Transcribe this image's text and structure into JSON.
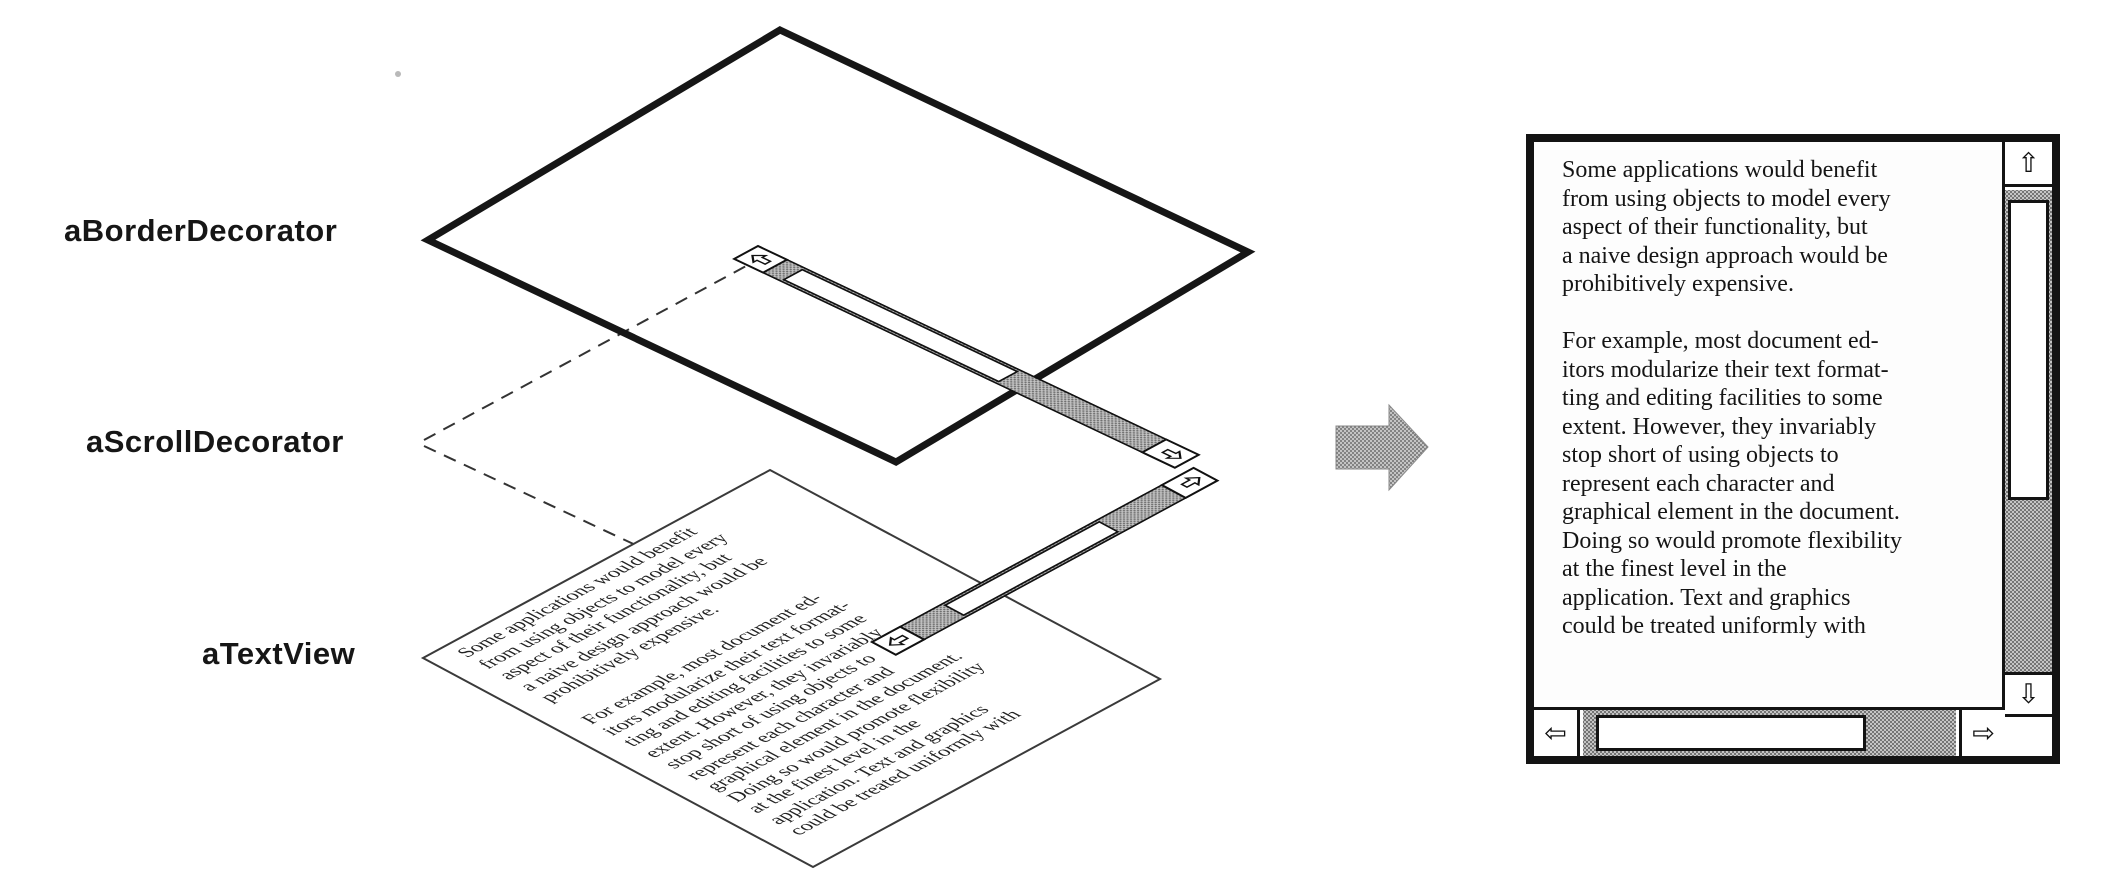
{
  "figure": {
    "labels": [
      {
        "id": "layer1",
        "text": "aBorderDecorator"
      },
      {
        "id": "layer2",
        "text": "aScrollDecorator"
      },
      {
        "id": "layer3",
        "text": "aTextView"
      }
    ]
  },
  "document_text": {
    "lines": [
      "Some applications would benefit",
      "from using objects to model every",
      "aspect of their functionality, but",
      "a naive design approach would be",
      "prohibitively expensive.",
      "",
      "For example, most document ed-",
      "itors modularize their text format-",
      "ting and editing facilities to some",
      "extent. However, they invariably",
      "stop short of using objects to",
      "represent each character and",
      "graphical element in the document.",
      "Doing so would promote flexibility",
      "at the finest level in the",
      "application.  Text and graphics",
      "could be treated uniformly with"
    ]
  },
  "composed_window": {
    "scrollbar_glyphs": {
      "up": "⇧",
      "down": "⇩",
      "left": "⇦",
      "right": "⇨"
    }
  },
  "watermark": {
    "text": "CSDN @程序猿KIMI",
    "color": "#b5b5b5"
  },
  "colors": {
    "ink": "#131313",
    "dither_base": "#c4c4c4",
    "dither_dot": "#6e6e6e"
  }
}
